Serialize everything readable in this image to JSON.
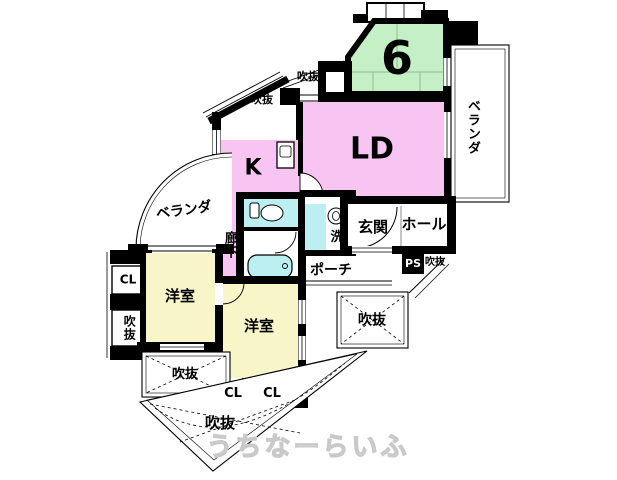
{
  "colors": {
    "wall": "#000000",
    "room_pink": "#f8c4f2",
    "room_green": "#c5efc5",
    "room_yellow": "#f8f5c8",
    "fixture_cyan": "#bceff2",
    "tatami_line": "#8fbf8f",
    "watermark": "#cccccc"
  },
  "rooms": {
    "tatami_number": "6",
    "living_dining": "LD",
    "kitchen": "K",
    "western_room_1": "洋室",
    "western_room_2": "洋室",
    "corridor": "廊下",
    "entrance": "玄関",
    "hall": "ホール",
    "porch": "ポーチ",
    "washroom": "洗",
    "veranda_left": "ベランダ",
    "veranda_right": "ベランダ",
    "pipe_space": "PS",
    "closet_left": "CL",
    "closet_bottom_1": "CL",
    "closet_bottom_2": "CL",
    "void_top": "吹抜",
    "void_upper_left": "吹抜",
    "void_left": "吹抜",
    "void_right": "吹抜",
    "void_bottom_left": "吹抜",
    "void_bottom": "吹抜",
    "void_ps": "吹抜"
  },
  "watermark": "うちなーらいふ"
}
